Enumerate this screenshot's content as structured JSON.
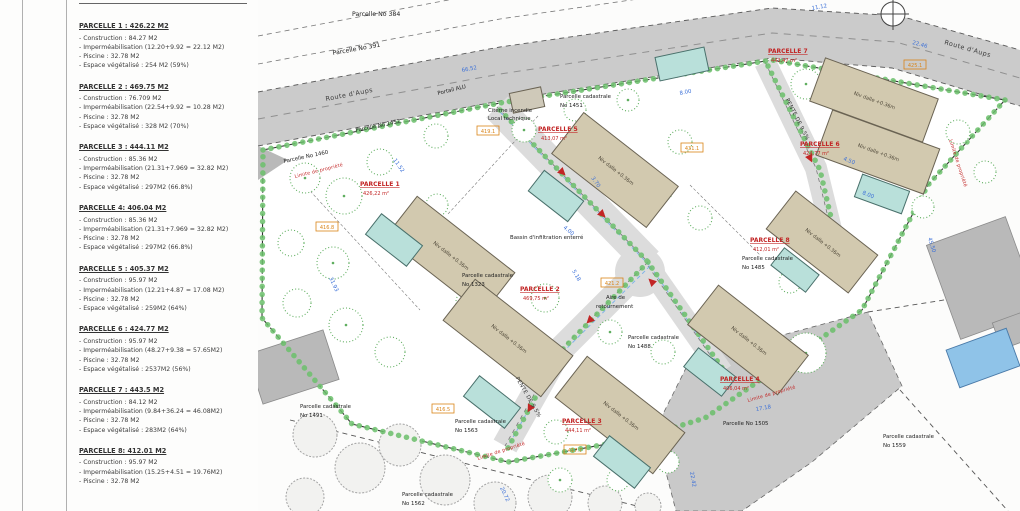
{
  "legend": {
    "parcels": [
      {
        "title": "PARCELLE 1 : 426.22 M2",
        "lines": [
          "- Construction : 84.27 M2",
          "- Imperméabilisation (12.20+9.92 = 22.12 M2)",
          "- Piscine : 32.78 M2",
          "- Espace végétalisé : 254 M2 (59%)"
        ]
      },
      {
        "title": "PARCELLE 2 : 469.75 M2",
        "lines": [
          "- Construction : 76.709 M2",
          "- Imperméabilisation (22.54+9.92 = 10.28 M2)",
          "- Piscine : 32.78 M2",
          "- Espace végétalisé : 328 M2 (70%)"
        ]
      },
      {
        "title": "PARCELLE 3 : 444.11 M2",
        "lines": [
          "- Construction : 85.36 M2",
          "- Imperméabilisation (21.31+7.969 = 32.82 M2)",
          "- Piscine : 32.78 M2",
          "- Espace végétalisé : 297M2 (66.8%)"
        ]
      },
      {
        "title": "PARCELLE 4: 406.04 M2",
        "lines": [
          "- Construction : 85.36 M2",
          "- Imperméabilisation (21.31+7.969 = 32.82 M2)",
          "- Piscine : 32.78 M2",
          "- Espace végétalisé : 297M2 (66.8%)"
        ]
      },
      {
        "title": "PARCELLE 5 : 405.37 M2",
        "lines": [
          "- Construction : 95.97 M2",
          "- Imperméabilisation (12.21+4.87 = 17.08 M2)",
          "- Piscine : 32.78 M2",
          "- Espace végétalisé : 259M2 (64%)"
        ]
      },
      {
        "title": "PARCELLE 6 : 424.77 M2",
        "lines": [
          "- Construction : 95.97 M2",
          "- Imperméabilisation (48.27+9.38 = 57.65M2)",
          "- Piscine : 32.78 M2",
          "- Espace végétalisé : 2537M2 (56%)"
        ]
      },
      {
        "title": "PARCELLE 7 : 443.5 M2",
        "lines": [
          "- Construction : 84.12 M2",
          "- Imperméabilisation (9.84+36.24 = 46.08M2)",
          "- Piscine : 32.78 M2",
          "- Espace végétalisé : 283M2 (64%)"
        ]
      },
      {
        "title": "PARCELLE 8: 412.01 M2",
        "lines": [
          "- Construction : 95.97 M2",
          "- Imperméabilisation (15.25+4.51 = 19.76M2)",
          "- Piscine : 32.78 M2"
        ]
      }
    ]
  },
  "plan": {
    "roads": {
      "route_daups": "Route d'Aups",
      "pente": "PENTE DE 9.5%"
    },
    "labels": {
      "p384": "Parcelle No 384",
      "p391": "Parcelle No 391",
      "p1452": "Parcelle No 1452",
      "p1460": "Parcelle No 1460",
      "p1505": "Parcelle No 1505"
    },
    "cadastral_prefix": "Parcelle cadastrale",
    "cad": {
      "n1451": "No 1451",
      "n1323": "No 1323",
      "n1488": "No 1488",
      "n1485": "No 1485",
      "n1491": "No 1491",
      "n1563": "No 1563",
      "n1562": "No 1562",
      "n1559": "No 1559"
    },
    "annotations": {
      "portail": "Portail ALU",
      "citerne_l1": "Citerne incendie",
      "citerne_l2": "Local technique",
      "aire_l1": "Aire de",
      "aire_l2": "retournement",
      "bassin": "Bassin d'infiltration enterré",
      "limite": "Limite de propriété"
    },
    "niv_dalle": "Niv dalle +0.36m",
    "parcelles": [
      {
        "name": "PARCELLE 1",
        "area": "426,22 m²"
      },
      {
        "name": "PARCELLE 2",
        "area": "469,75 m²"
      },
      {
        "name": "PARCELLE 3",
        "area": "444,11 m²"
      },
      {
        "name": "PARCELLE 4",
        "area": "406,04 m²"
      },
      {
        "name": "PARCELLE 5",
        "area": "413,07 m²"
      },
      {
        "name": "PARCELLE 6",
        "area": "424,77 m²"
      },
      {
        "name": "PARCELLE 7",
        "area": "443,47 m²"
      },
      {
        "name": "PARCELLE 8",
        "area": "412,01 m²"
      }
    ],
    "dims": [
      {
        "t": "66.52"
      },
      {
        "t": "11.12"
      },
      {
        "t": "22.46"
      },
      {
        "t": "45.50"
      },
      {
        "t": "17.18"
      },
      {
        "t": "22.42"
      },
      {
        "t": "31.93"
      },
      {
        "t": "11.52"
      },
      {
        "t": "8.00"
      },
      {
        "t": "4.00"
      },
      {
        "t": "3.70"
      },
      {
        "t": "5.18"
      },
      {
        "t": "4.50"
      },
      {
        "t": "20.72"
      },
      {
        "t": "8.00"
      }
    ],
    "elevations": [
      {
        "t": "419.1"
      },
      {
        "t": "416.8"
      },
      {
        "t": "416.5"
      },
      {
        "t": "417.7"
      },
      {
        "t": "425.1"
      },
      {
        "t": "431.1"
      },
      {
        "t": "421.2"
      }
    ],
    "colors": {
      "parcel_label": "#c22525",
      "dimension": "#3a6fd8",
      "elevation": "#d98418",
      "building": "#d2c9af",
      "pool": "#b9e0da",
      "road": "#cbcbcb",
      "tree": "#5fae5f"
    }
  }
}
